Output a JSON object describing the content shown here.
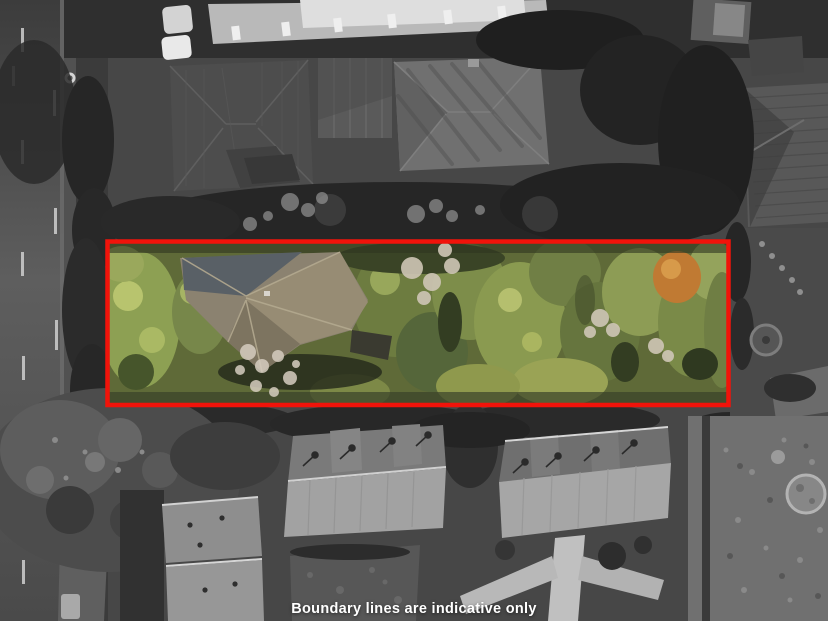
{
  "caption": {
    "text": "Boundary lines are indicative only"
  },
  "boundary": {
    "color": "#F1130A"
  }
}
